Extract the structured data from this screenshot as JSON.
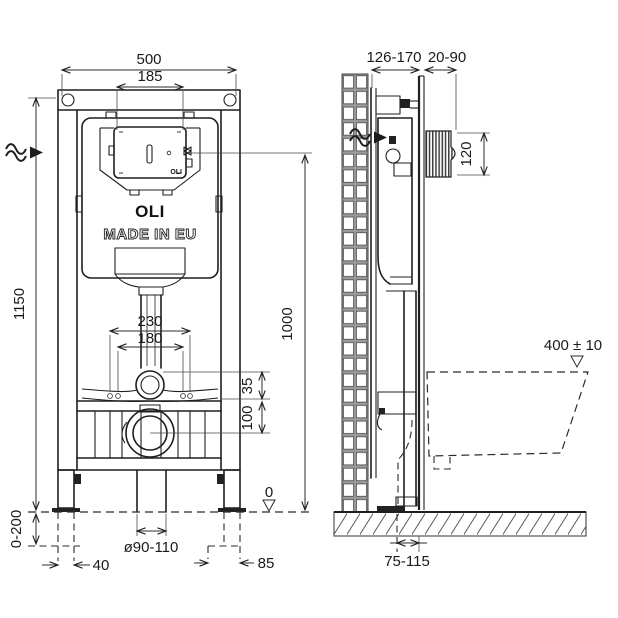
{
  "branding": {
    "logo": "OLI",
    "made_in": "MADE IN EU",
    "panel_logo": "OLI"
  },
  "dimensions": {
    "front": {
      "frame_width": "500",
      "panel_width": "185",
      "frame_height": "1150",
      "fixing_width_outer": "230",
      "fixing_width_inner": "180",
      "inlet_offset": "35",
      "outlet_offset": "100",
      "leg_adjustment": "0-200",
      "floor_level": "0",
      "foot_offset_left": "40",
      "drain_diameter": "ø90-110",
      "foot_offset_right": "85"
    },
    "side": {
      "frame_depth": "126-170",
      "wall_thickness": "20-90",
      "plate_height": "120",
      "panel_height": "1000",
      "bowl_top_height": "400 ± 10",
      "outlet_distance": "75-115"
    }
  }
}
